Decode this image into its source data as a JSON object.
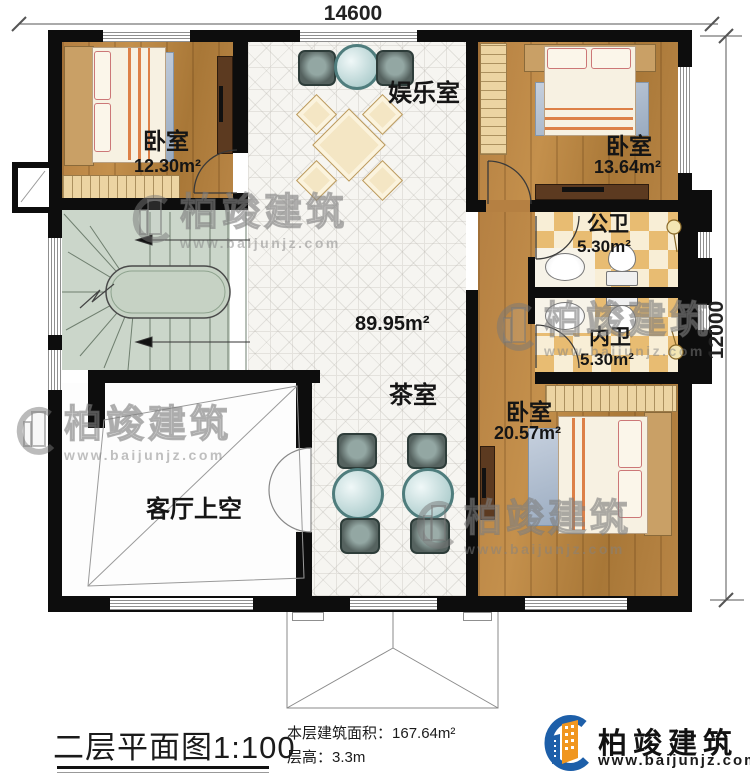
{
  "dimensions": {
    "width_mm": "14600",
    "height_mm": "12000"
  },
  "labels": {
    "bedroom1_name": "卧室",
    "bedroom1_area": "12.30m²",
    "bedroom2_name": "卧室",
    "bedroom2_area": "13.64m²",
    "bedroom3_name": "卧室",
    "bedroom3_area": "20.57m²",
    "entertainment": "娱乐室",
    "tea_room": "茶室",
    "public_bath_name": "公卫",
    "public_bath_area": "5.30m²",
    "ensuite_bath_name": "内卫",
    "ensuite_bath_area": "5.30m²",
    "living_void": "客厅上空",
    "open_area": "89.95m²"
  },
  "watermark": {
    "brand": "柏竣建筑",
    "url": "www.baijunjz.com"
  },
  "title_block": {
    "title": "二层平面图1:100",
    "area_label": "本层建筑面积：",
    "area_value": "167.64m²",
    "height_label": "层高：",
    "height_value": "3.3m"
  },
  "logo": {
    "brand": "柏竣建筑",
    "url": "www.baijunjz.com"
  },
  "colors": {
    "wall": "#0d0d0d",
    "wood": "#b58042",
    "tile": "#f6f5f1",
    "checker": "#e8bc72",
    "stairs": "#cbd6ca",
    "logo_blue": "#1d5fa9",
    "logo_orange": "#f0961f"
  }
}
